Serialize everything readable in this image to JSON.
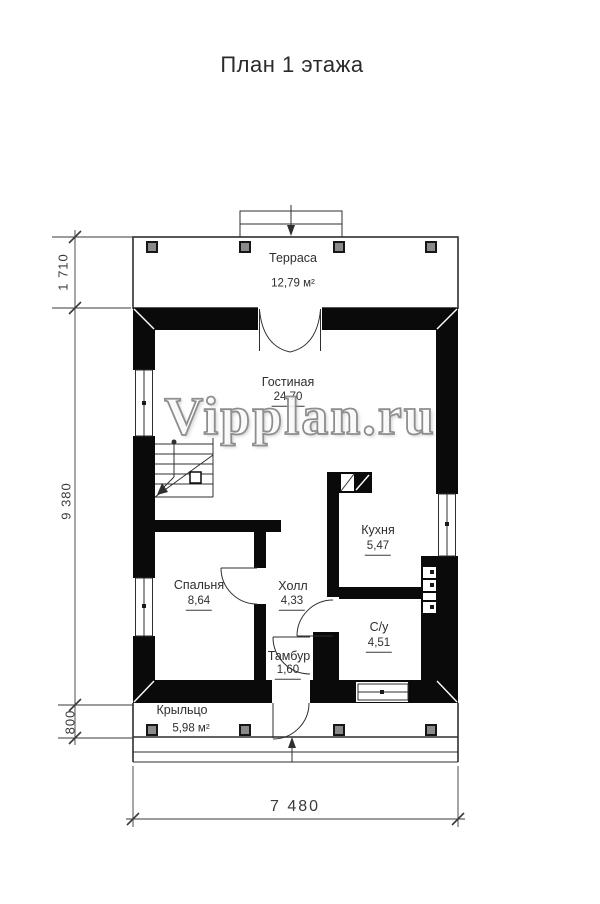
{
  "title": "План 1 этажа",
  "watermark": "Vipplan.ru",
  "rooms": {
    "terrace": {
      "name": "Терраса",
      "area": "12,79 м²"
    },
    "living": {
      "name": "Гостиная",
      "area": "24,70"
    },
    "kitchen": {
      "name": "Кухня",
      "area": "5,47"
    },
    "bedroom": {
      "name": "Спальня",
      "area": "8,64"
    },
    "hall": {
      "name": "Холл",
      "area": "4,33"
    },
    "tambour": {
      "name": "Тамбур",
      "area": "1,60"
    },
    "bathroom": {
      "name": "С/у",
      "area": "4,51"
    },
    "porch": {
      "name": "Крыльцо",
      "area": "5,98 м²"
    }
  },
  "dimensions": {
    "terrace_depth": "1 710",
    "house_length": "9 380",
    "porch_depth": "800",
    "house_width": "7 480"
  },
  "colors": {
    "wall": "#0a0a0a",
    "line": "#2f2f2f",
    "dim": "#3a3a3a",
    "text": "#2e2e2e",
    "watermark": "#8e8e8e"
  }
}
